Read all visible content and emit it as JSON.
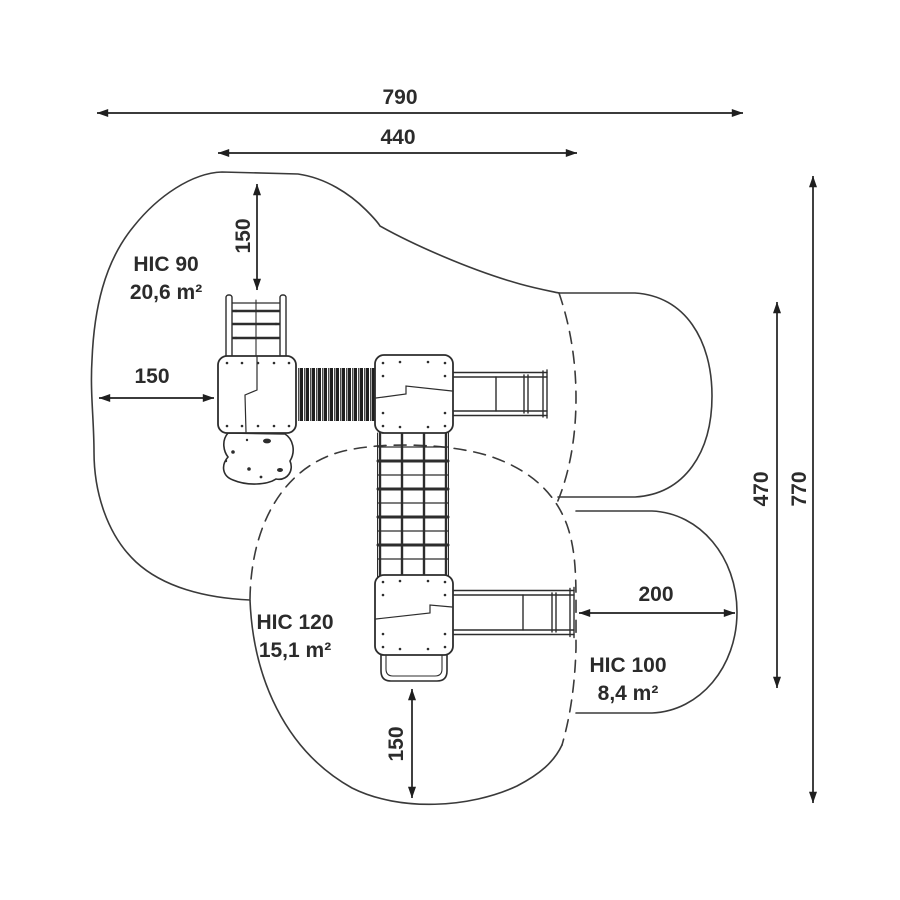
{
  "drawing": {
    "kind": "playground-safety-zone-plan"
  },
  "colors": {
    "background": "#ffffff",
    "ink": "#2b2b2b",
    "zone_line": "#3a3a3a",
    "structure_line": "#2d2d2d",
    "dimension_line": "#1f1f1f",
    "tunnel_fill": "#1e1e1e"
  },
  "dimensions": {
    "overall_width": "790",
    "platform_width": "440",
    "top_margin": "150",
    "left_margin": "150",
    "bottom_margin": "150",
    "slide_runout": "200",
    "right_inner_height": "470",
    "overall_height": "770"
  },
  "zones": {
    "hic90": {
      "label": "HIC 90",
      "area": "20,6 m²"
    },
    "hic120": {
      "label": "HIC 120",
      "area": "15,1 m²"
    },
    "hic100": {
      "label": "HIC 100",
      "area": "8,4 m²"
    }
  }
}
